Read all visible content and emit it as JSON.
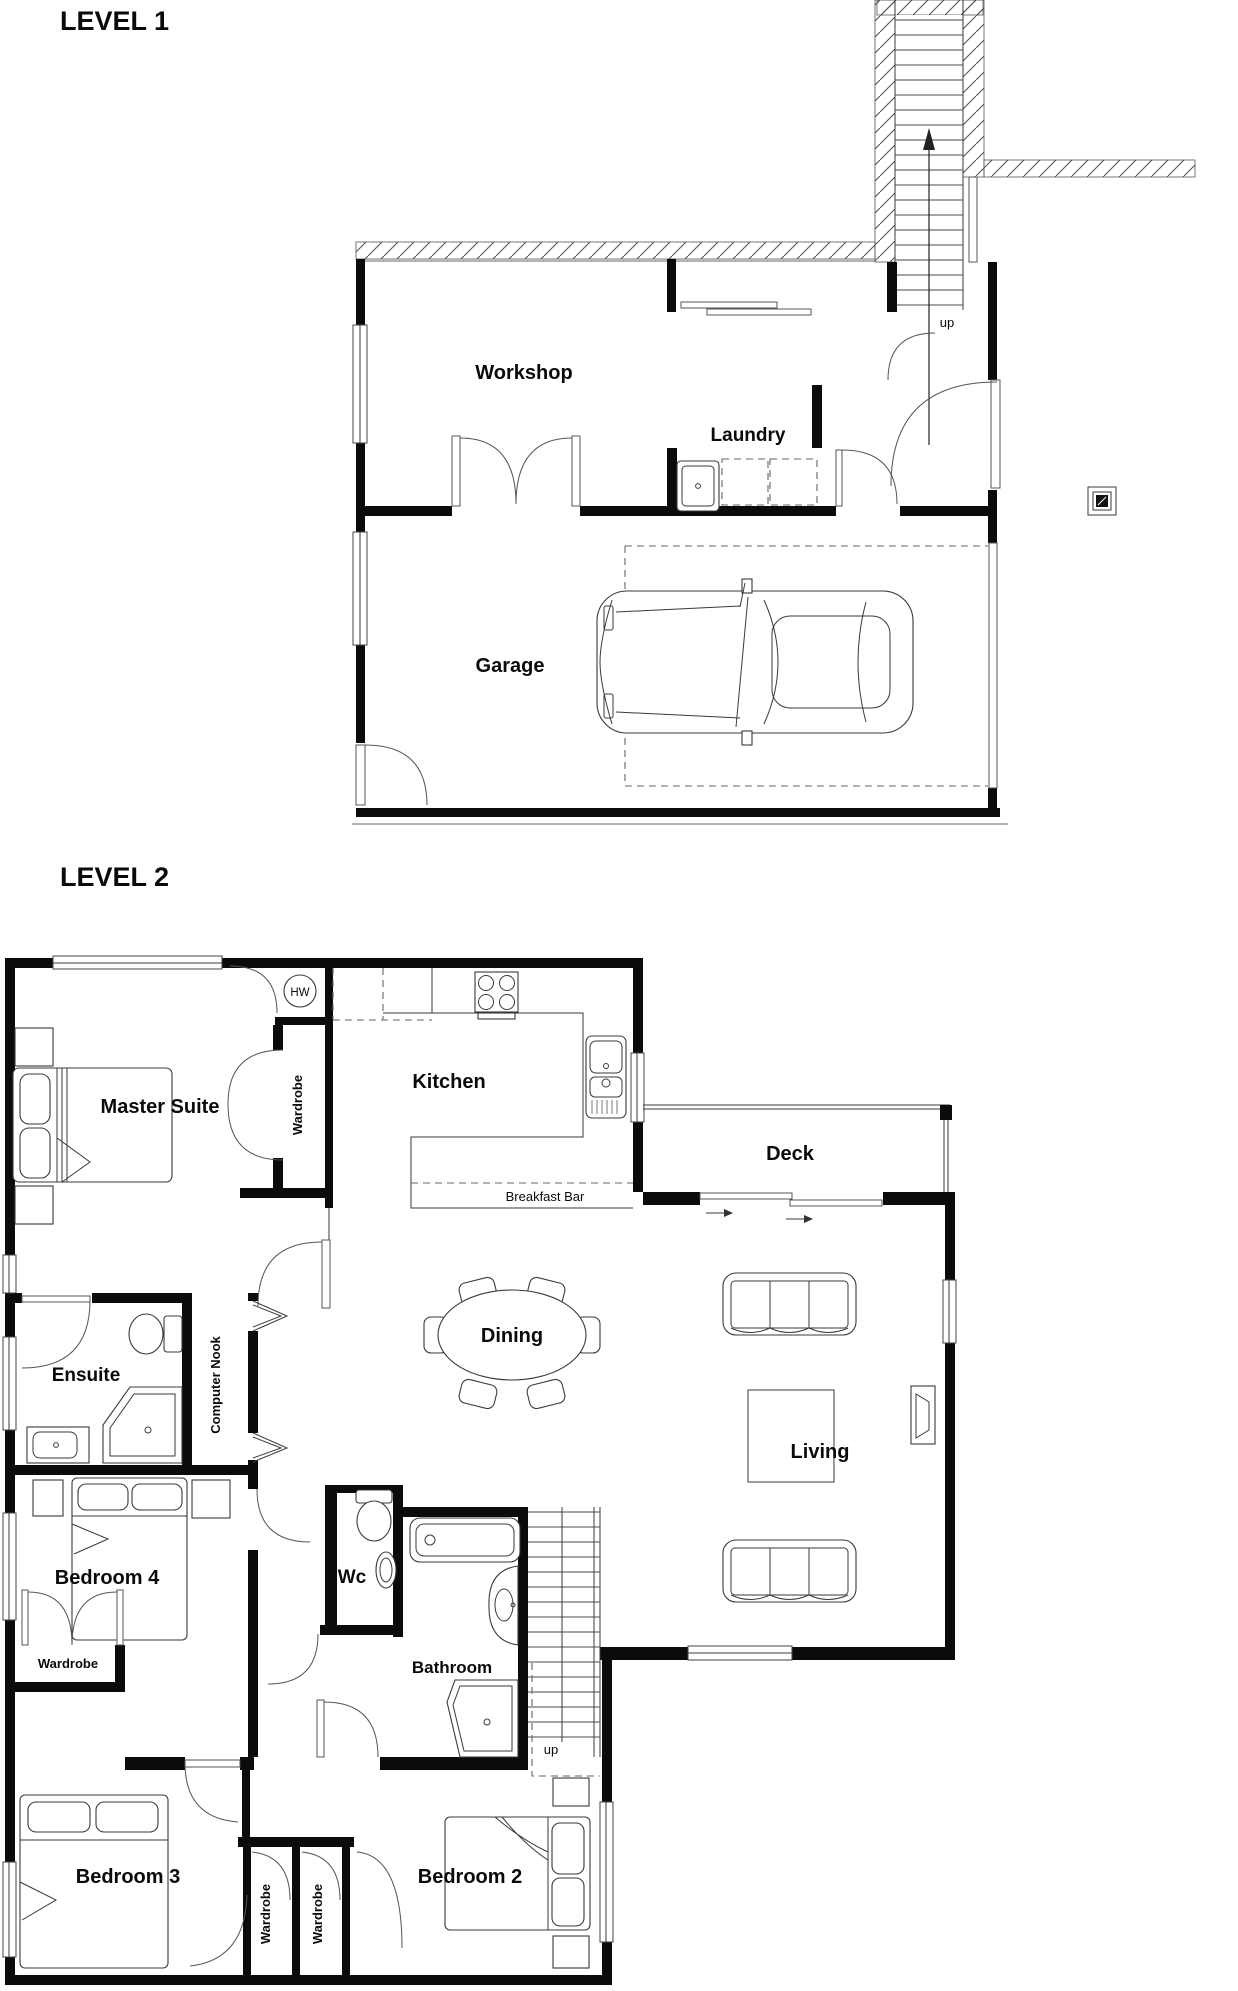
{
  "document": {
    "background": "#ffffff",
    "ink": "#0b0b0b"
  },
  "level1": {
    "title": "LEVEL 1",
    "rooms": {
      "workshop": "Workshop",
      "laundry": "Laundry",
      "garage": "Garage"
    },
    "stairs": {
      "label": "up"
    }
  },
  "level2": {
    "title": "LEVEL 2",
    "rooms": {
      "master_suite": "Master Suite",
      "kitchen": "Kitchen",
      "deck": "Deck",
      "dining": "Dining",
      "living": "Living",
      "ensuite": "Ensuite",
      "computer_nook": "Computer Nook",
      "bedroom4": "Bedroom 4",
      "wc": "Wc",
      "bathroom": "Bathroom",
      "bedroom3": "Bedroom 3",
      "bedroom2": "Bedroom 2"
    },
    "features": {
      "hot_water": "HW",
      "breakfast_bar": "Breakfast Bar",
      "wardrobe_master": "Wardrobe",
      "wardrobe_bed4": "Wardrobe",
      "wardrobe_left": "Wardrobe",
      "wardrobe_right": "Wardrobe"
    },
    "stairs": {
      "label": "up"
    }
  }
}
